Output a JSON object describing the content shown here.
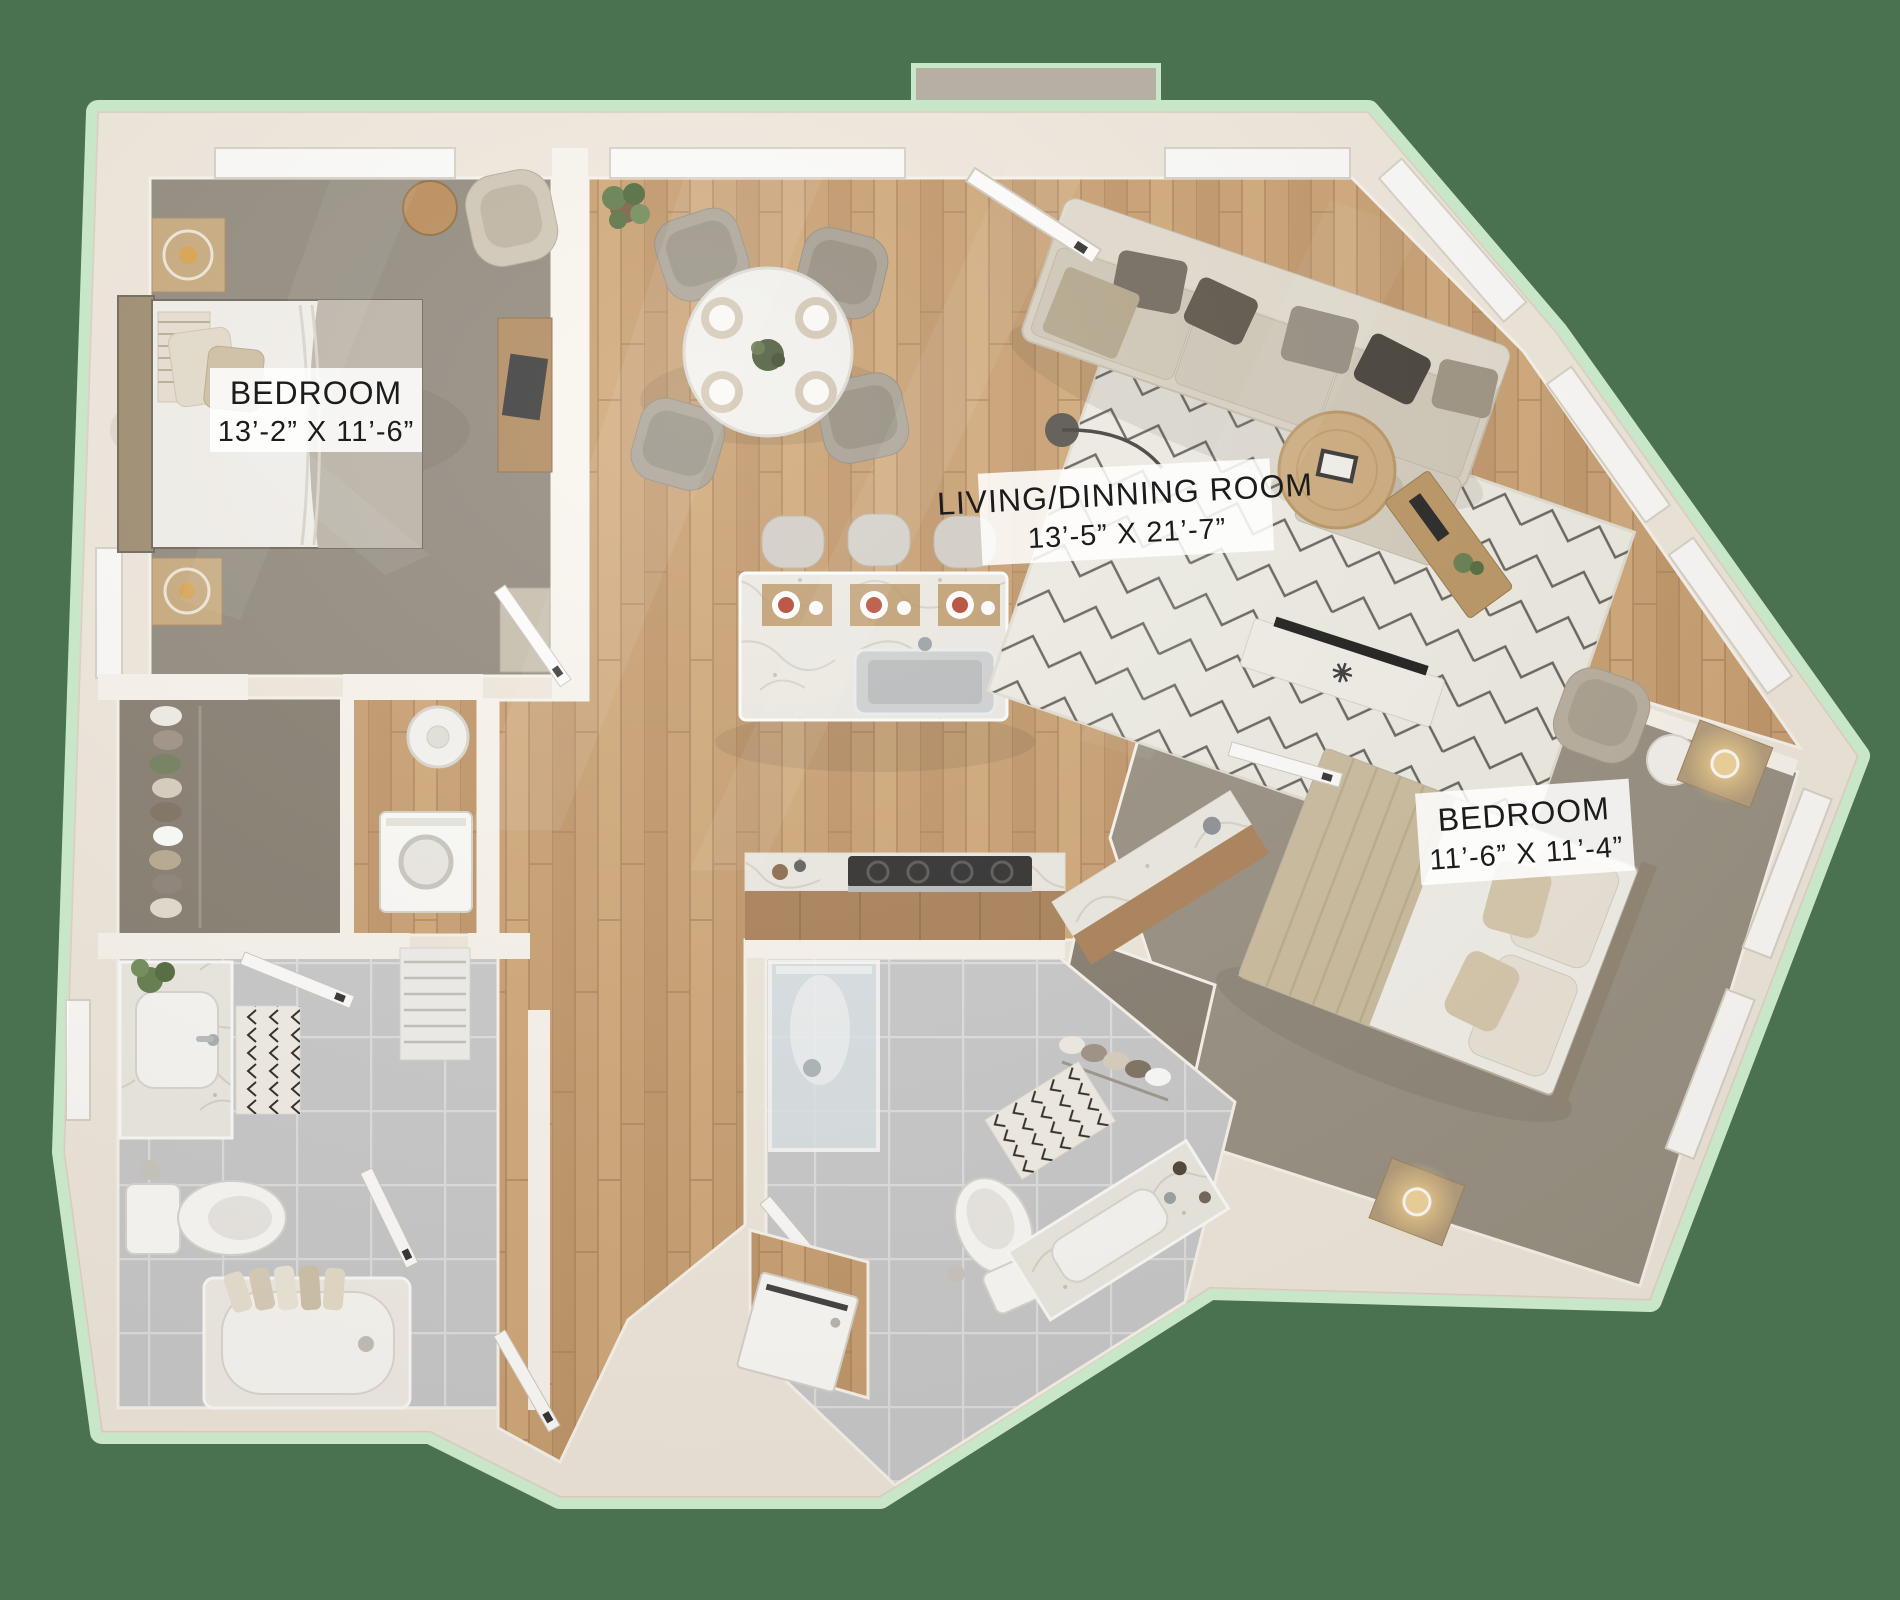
{
  "scene": {
    "description": "3D rendered top-down two-bedroom apartment floor plan on green background",
    "background_color": "#4a7150",
    "outline_glow_color": "#c8e7c8",
    "wall_color": "#f0e9de",
    "entry_pad_color": "#b6afa3"
  },
  "rooms": {
    "bedroom_1": {
      "label": "BEDROOM",
      "dimensions": "13’-2” X 11’-6”"
    },
    "living_dining": {
      "label": "LIVING/DINNING ROOM",
      "dimensions": "13’-5” X 21’-7”"
    },
    "bedroom_2": {
      "label": "BEDROOM",
      "dimensions": "11’-6” X 11’-4”"
    }
  },
  "palette": {
    "wood_floor": "#c89e6f",
    "cabinet_wood": "#a97f56",
    "carpet": "#8f887c",
    "closet_carpet": "#837b6e",
    "tile": "#c8c9cb",
    "marble": "#edebe4",
    "rug": "#efede5",
    "sofa": "#d8d1c3"
  }
}
